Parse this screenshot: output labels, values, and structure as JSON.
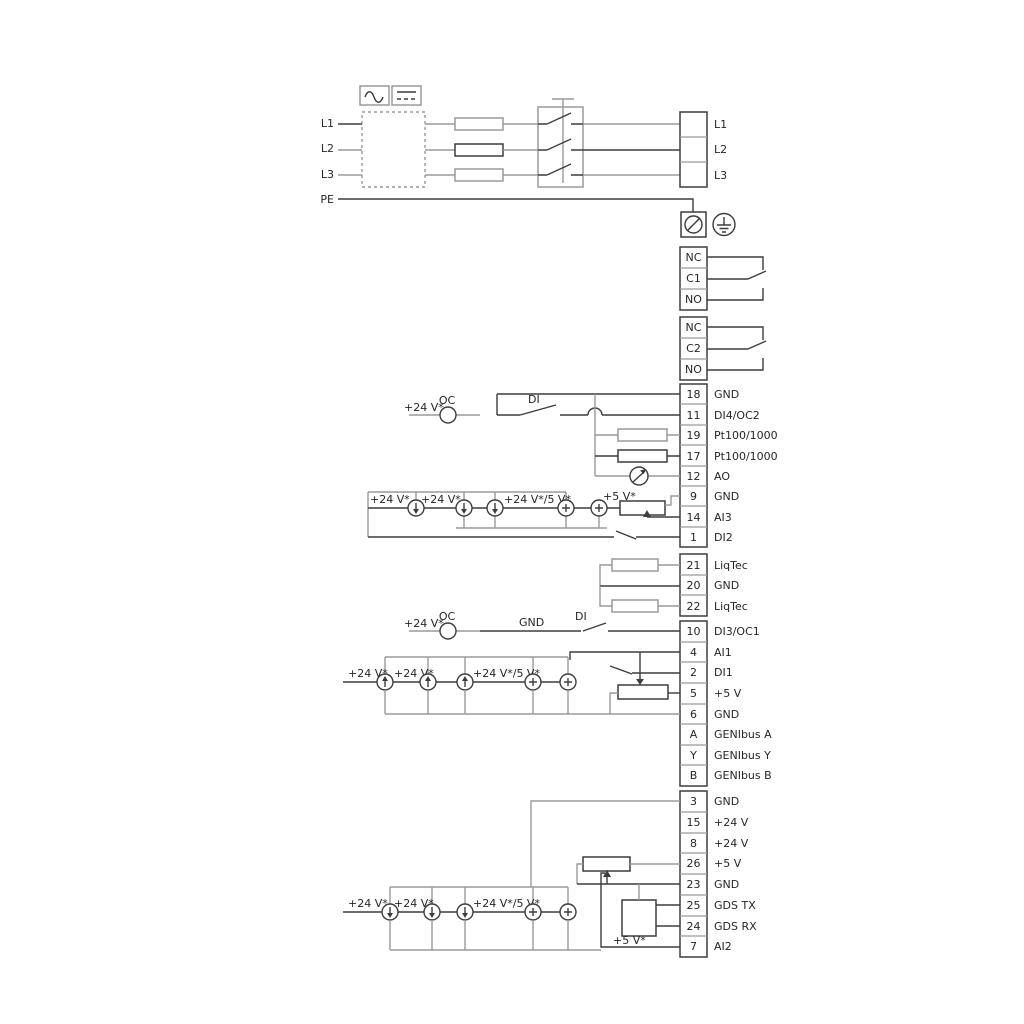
{
  "figure": {
    "mains": {
      "inputs": [
        "L1",
        "L2",
        "L3",
        "PE"
      ],
      "outputs": [
        "L1",
        "L2",
        "L3"
      ]
    },
    "relay1": {
      "rows": [
        "NC",
        "C1",
        "NO"
      ]
    },
    "relay2": {
      "rows": [
        "NC",
        "C2",
        "NO"
      ]
    },
    "strip1": {
      "rows": [
        {
          "num": "18",
          "label": "GND"
        },
        {
          "num": "11",
          "label": "DI4/OC2"
        },
        {
          "num": "19",
          "label": "Pt100/1000"
        },
        {
          "num": "17",
          "label": "Pt100/1000"
        },
        {
          "num": "12",
          "label": "AO"
        },
        {
          "num": "9",
          "label": "GND"
        },
        {
          "num": "14",
          "label": "AI3"
        },
        {
          "num": "1",
          "label": "DI2"
        }
      ]
    },
    "strip2": {
      "rows": [
        {
          "num": "21",
          "label": "LiqTec"
        },
        {
          "num": "20",
          "label": "GND"
        },
        {
          "num": "22",
          "label": "LiqTec"
        }
      ]
    },
    "strip3": {
      "rows": [
        {
          "num": "10",
          "label": "DI3/OC1"
        },
        {
          "num": "4",
          "label": "AI1"
        },
        {
          "num": "2",
          "label": "DI1"
        },
        {
          "num": "5",
          "label": "+5 V"
        },
        {
          "num": "6",
          "label": "GND"
        },
        {
          "num": "A",
          "label": "GENIbus A"
        },
        {
          "num": "Y",
          "label": "GENIbus Y"
        },
        {
          "num": "B",
          "label": "GENIbus B"
        }
      ]
    },
    "strip4": {
      "rows": [
        {
          "num": "3",
          "label": "GND"
        },
        {
          "num": "15",
          "label": "+24 V"
        },
        {
          "num": "8",
          "label": "+24 V"
        },
        {
          "num": "26",
          "label": "+5 V"
        },
        {
          "num": "23",
          "label": "GND"
        },
        {
          "num": "25",
          "label": "GDS TX"
        },
        {
          "num": "24",
          "label": "GDS RX"
        },
        {
          "num": "7",
          "label": "AI2"
        }
      ]
    },
    "labels": {
      "v24": "+24 V*",
      "v24or5": "+24 V*/5 V*",
      "v5": "+5 V*",
      "oc": "OC",
      "di": "DI",
      "gnd": "GND"
    },
    "colors": {
      "wire_gray": "#9a9a9a",
      "wire_dark": "#3d3d3d"
    }
  }
}
